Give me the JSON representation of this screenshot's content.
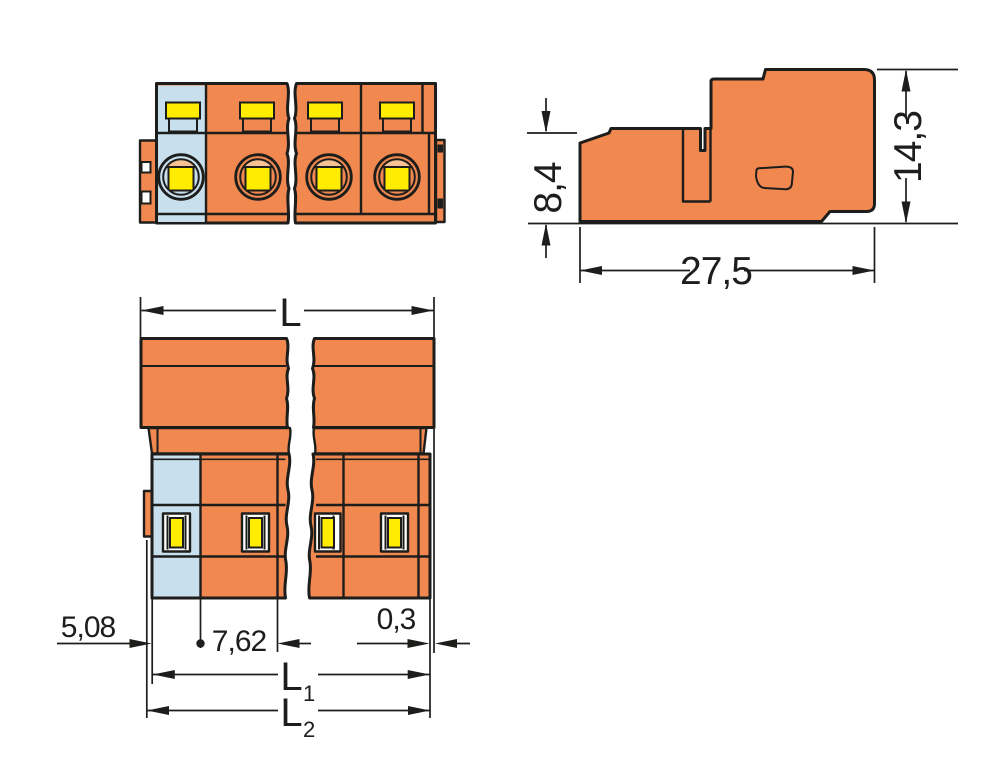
{
  "colors": {
    "outline": "#1d1d1b",
    "orange": "#f0884f",
    "blue": "#c8e0ee",
    "yellow": "#ffec00",
    "peach": "#f6c193"
  },
  "side_view": {
    "height_front": "8,4",
    "height_total": "14,3",
    "depth": "27,5"
  },
  "top_view": {
    "length": "L",
    "pin_offset": "5,08",
    "pitch": "7,62",
    "end_gap": "0,3",
    "l1": "L",
    "l1_sub": "1",
    "l2": "L",
    "l2_sub": "2"
  }
}
